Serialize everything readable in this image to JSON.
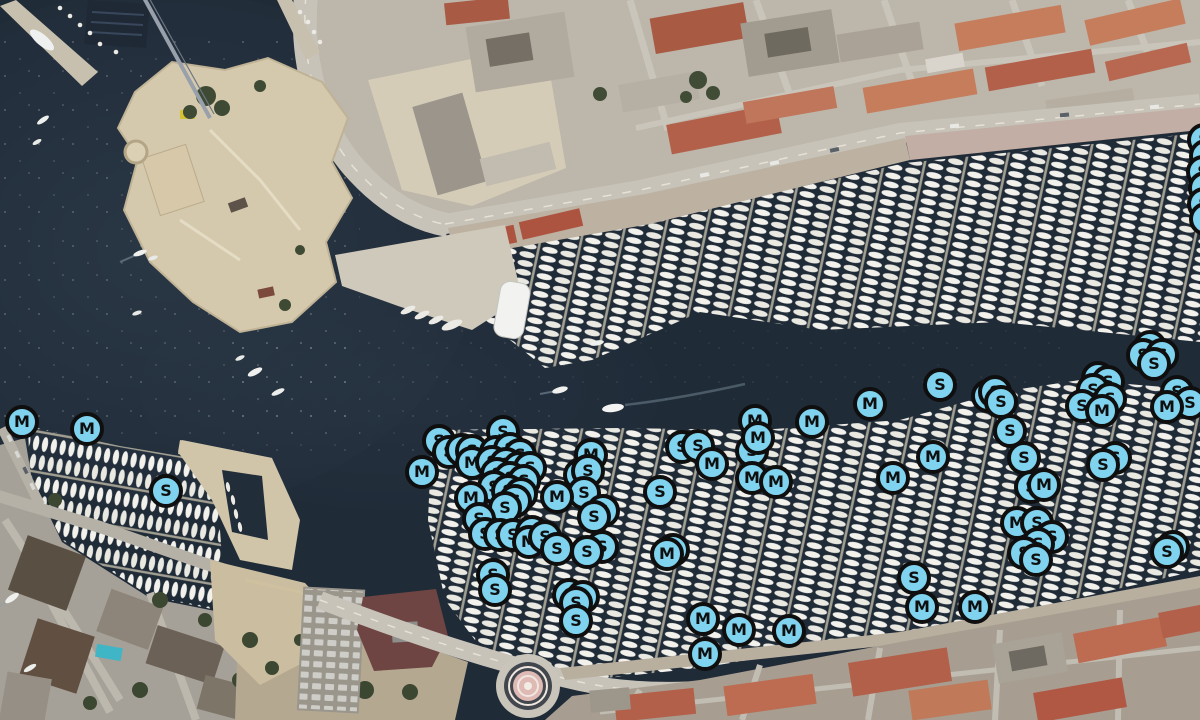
{
  "map": {
    "view": "satellite",
    "marker_letters": [
      "M",
      "S"
    ]
  },
  "marker_style": {
    "fill": "#7fd3ef",
    "border": "#0f0f0f",
    "letter_color": "#0f0f0f"
  },
  "markers": [
    [
      22,
      422,
      "M"
    ],
    [
      87,
      429,
      "M"
    ],
    [
      166,
      491,
      "S"
    ],
    [
      439,
      441,
      "S"
    ],
    [
      449,
      452,
      "S"
    ],
    [
      462,
      450,
      "S"
    ],
    [
      503,
      432,
      "S"
    ],
    [
      472,
      451,
      "S"
    ],
    [
      472,
      463,
      "M"
    ],
    [
      422,
      472,
      "M"
    ],
    [
      496,
      452,
      "S"
    ],
    [
      510,
      449,
      "S"
    ],
    [
      520,
      455,
      "S"
    ],
    [
      492,
      462,
      "S"
    ],
    [
      506,
      464,
      "S"
    ],
    [
      519,
      468,
      "S"
    ],
    [
      530,
      468,
      "S"
    ],
    [
      497,
      474,
      "S"
    ],
    [
      510,
      478,
      "S"
    ],
    [
      524,
      481,
      "S"
    ],
    [
      494,
      487,
      "S"
    ],
    [
      508,
      491,
      "S"
    ],
    [
      521,
      494,
      "S"
    ],
    [
      515,
      501,
      "S"
    ],
    [
      505,
      508,
      "S"
    ],
    [
      471,
      498,
      "M"
    ],
    [
      479,
      519,
      "S"
    ],
    [
      591,
      455,
      "M"
    ],
    [
      580,
      475,
      "S"
    ],
    [
      588,
      471,
      "S"
    ],
    [
      584,
      493,
      "S"
    ],
    [
      603,
      511,
      "S"
    ],
    [
      594,
      517,
      "S"
    ],
    [
      557,
      497,
      "M"
    ],
    [
      485,
      534,
      "S"
    ],
    [
      500,
      535,
      "S"
    ],
    [
      513,
      535,
      "S"
    ],
    [
      532,
      532,
      "S"
    ],
    [
      529,
      542,
      "M"
    ],
    [
      545,
      537,
      "S"
    ],
    [
      557,
      549,
      "S"
    ],
    [
      602,
      547,
      "S"
    ],
    [
      587,
      552,
      "S"
    ],
    [
      493,
      575,
      "S"
    ],
    [
      495,
      590,
      "S"
    ],
    [
      569,
      595,
      "S"
    ],
    [
      583,
      597,
      "S"
    ],
    [
      576,
      603,
      "S"
    ],
    [
      576,
      621,
      "S"
    ],
    [
      660,
      492,
      "S"
    ],
    [
      682,
      447,
      "S"
    ],
    [
      698,
      446,
      "S"
    ],
    [
      712,
      464,
      "M"
    ],
    [
      752,
      451,
      "S"
    ],
    [
      755,
      421,
      "M"
    ],
    [
      758,
      438,
      "M"
    ],
    [
      812,
      422,
      "M"
    ],
    [
      870,
      404,
      "M"
    ],
    [
      752,
      478,
      "M"
    ],
    [
      776,
      482,
      "M"
    ],
    [
      893,
      478,
      "M"
    ],
    [
      673,
      550,
      "M"
    ],
    [
      667,
      554,
      "M"
    ],
    [
      703,
      619,
      "M"
    ],
    [
      739,
      630,
      "M"
    ],
    [
      789,
      631,
      "M"
    ],
    [
      705,
      654,
      "M"
    ],
    [
      940,
      385,
      "S"
    ],
    [
      988,
      396,
      "S"
    ],
    [
      995,
      392,
      "S"
    ],
    [
      1001,
      402,
      "S"
    ],
    [
      1010,
      431,
      "S"
    ],
    [
      933,
      457,
      "M"
    ],
    [
      1024,
      458,
      "S"
    ],
    [
      1150,
      347,
      "S"
    ],
    [
      1143,
      355,
      "S"
    ],
    [
      1162,
      355,
      "S"
    ],
    [
      1154,
      364,
      "S"
    ],
    [
      1098,
      378,
      "S"
    ],
    [
      1108,
      382,
      "S"
    ],
    [
      1093,
      390,
      "S"
    ],
    [
      1110,
      399,
      "S"
    ],
    [
      1082,
      406,
      "S"
    ],
    [
      1102,
      411,
      "M"
    ],
    [
      1177,
      392,
      "S"
    ],
    [
      1190,
      403,
      "S"
    ],
    [
      1167,
      407,
      "M"
    ],
    [
      1115,
      458,
      "S"
    ],
    [
      1103,
      465,
      "S"
    ],
    [
      1031,
      487,
      "S"
    ],
    [
      1044,
      485,
      "M"
    ],
    [
      1017,
      523,
      "M"
    ],
    [
      1037,
      523,
      "S"
    ],
    [
      1052,
      537,
      "S"
    ],
    [
      1038,
      544,
      "S"
    ],
    [
      1024,
      553,
      "S"
    ],
    [
      1036,
      560,
      "S"
    ],
    [
      1173,
      547,
      "S"
    ],
    [
      1167,
      552,
      "S"
    ],
    [
      914,
      578,
      "S"
    ],
    [
      922,
      607,
      "M"
    ],
    [
      975,
      607,
      "M"
    ],
    [
      1204,
      140,
      "S"
    ],
    [
      1206,
      156,
      "S"
    ],
    [
      1203,
      172,
      "S"
    ],
    [
      1205,
      188,
      "S"
    ],
    [
      1204,
      204,
      "S"
    ],
    [
      1206,
      219,
      "S"
    ]
  ]
}
